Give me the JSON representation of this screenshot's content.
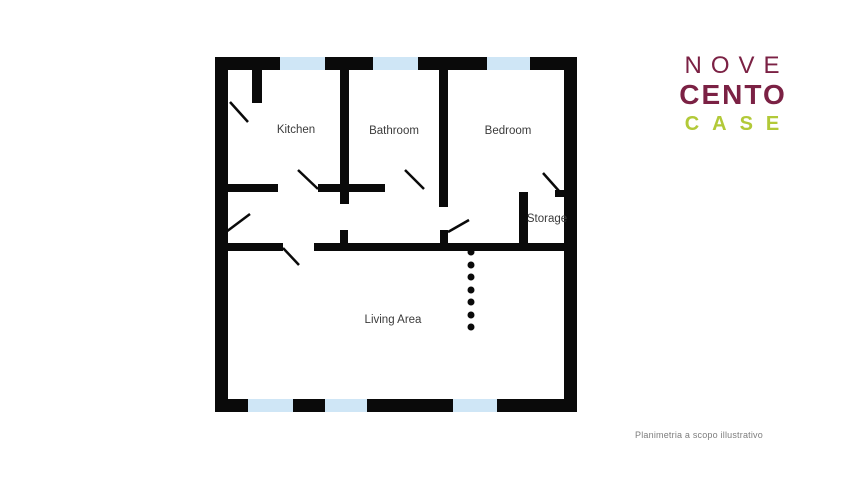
{
  "branding": {
    "nove": "NOVE",
    "cento": "CENTO",
    "case": "CASE",
    "maroon": "#7b2144",
    "green": "#b2c938"
  },
  "footer": {
    "disclaimer": "Planimetria a scopo illustrativo",
    "color": "#7d7d7d"
  },
  "floorplan": {
    "wall_color": "#0a0a0a",
    "window_color": "#cfe6f6",
    "label_color": "#3b3b3b",
    "label_font_size": 11.5,
    "rooms": [
      {
        "name": "Kitchen",
        "x": 296,
        "y": 130
      },
      {
        "name": "Bathroom",
        "x": 394,
        "y": 131
      },
      {
        "name": "Bedroom",
        "x": 508,
        "y": 131
      },
      {
        "name": "Storage",
        "x": 547,
        "y": 219
      },
      {
        "name": "Living Area",
        "x": 393,
        "y": 320
      }
    ],
    "walls": [
      {
        "name": "outer-top",
        "x": 215,
        "y": 57,
        "w": 362,
        "h": 13
      },
      {
        "name": "outer-bottom",
        "x": 215,
        "y": 399,
        "w": 362,
        "h": 13
      },
      {
        "name": "outer-left",
        "x": 215,
        "y": 57,
        "w": 13,
        "h": 355
      },
      {
        "name": "outer-right",
        "x": 564,
        "y": 57,
        "w": 13,
        "h": 355
      },
      {
        "name": "kitchen-stub",
        "x": 252,
        "y": 70,
        "w": 10,
        "h": 33
      },
      {
        "name": "kitchen-bath-divider",
        "x": 340,
        "y": 70,
        "w": 9,
        "h": 134
      },
      {
        "name": "bath-bedroom-divider",
        "x": 439,
        "y": 70,
        "w": 9,
        "h": 137
      },
      {
        "name": "storage-left-wall",
        "x": 519,
        "y": 192,
        "w": 9,
        "h": 53
      },
      {
        "name": "storage-right-stub",
        "x": 555,
        "y": 190,
        "w": 11,
        "h": 7
      },
      {
        "name": "kitchen-bottom-wall",
        "x": 228,
        "y": 184,
        "w": 50,
        "h": 8
      },
      {
        "name": "bathroom-bottom-wall",
        "x": 318,
        "y": 184,
        "w": 67,
        "h": 8
      },
      {
        "name": "hall-bottom-left",
        "x": 228,
        "y": 243,
        "w": 55,
        "h": 8
      },
      {
        "name": "hall-bottom-right",
        "x": 314,
        "y": 243,
        "w": 250,
        "h": 8
      },
      {
        "name": "hall-stub-1",
        "x": 340,
        "y": 230,
        "w": 8,
        "h": 13
      },
      {
        "name": "hall-stub-2",
        "x": 440,
        "y": 230,
        "w": 8,
        "h": 13
      }
    ],
    "windows": [
      {
        "name": "window-top-1",
        "x": 280,
        "y": 57,
        "w": 45,
        "h": 13
      },
      {
        "name": "window-top-2",
        "x": 373,
        "y": 57,
        "w": 45,
        "h": 13
      },
      {
        "name": "window-top-3",
        "x": 487,
        "y": 57,
        "w": 43,
        "h": 13
      },
      {
        "name": "window-bottom-1",
        "x": 248,
        "y": 399,
        "w": 45,
        "h": 13
      },
      {
        "name": "window-bottom-2",
        "x": 325,
        "y": 399,
        "w": 42,
        "h": 13
      },
      {
        "name": "window-bottom-3",
        "x": 453,
        "y": 399,
        "w": 44,
        "h": 13
      }
    ],
    "door_swings": [
      {
        "name": "door-kitchen-entry",
        "x1": 230,
        "y1": 102,
        "x2": 248,
        "y2": 122
      },
      {
        "name": "door-kitchen-hall",
        "x1": 298,
        "y1": 170,
        "x2": 318,
        "y2": 189
      },
      {
        "name": "door-bathroom",
        "x1": 405,
        "y1": 170,
        "x2": 424,
        "y2": 189
      },
      {
        "name": "door-storage",
        "x1": 543,
        "y1": 173,
        "x2": 559,
        "y2": 191
      },
      {
        "name": "door-hall-left",
        "x1": 226,
        "y1": 232,
        "x2": 250,
        "y2": 214
      },
      {
        "name": "door-bedroom-hall",
        "x1": 448,
        "y1": 232,
        "x2": 469,
        "y2": 220
      },
      {
        "name": "door-living-area",
        "x1": 283,
        "y1": 248,
        "x2": 299,
        "y2": 265
      }
    ],
    "dotted_divider": {
      "x": 471,
      "ys": [
        252,
        265,
        277,
        290,
        302,
        315,
        327
      ],
      "radius": 3.5
    }
  }
}
